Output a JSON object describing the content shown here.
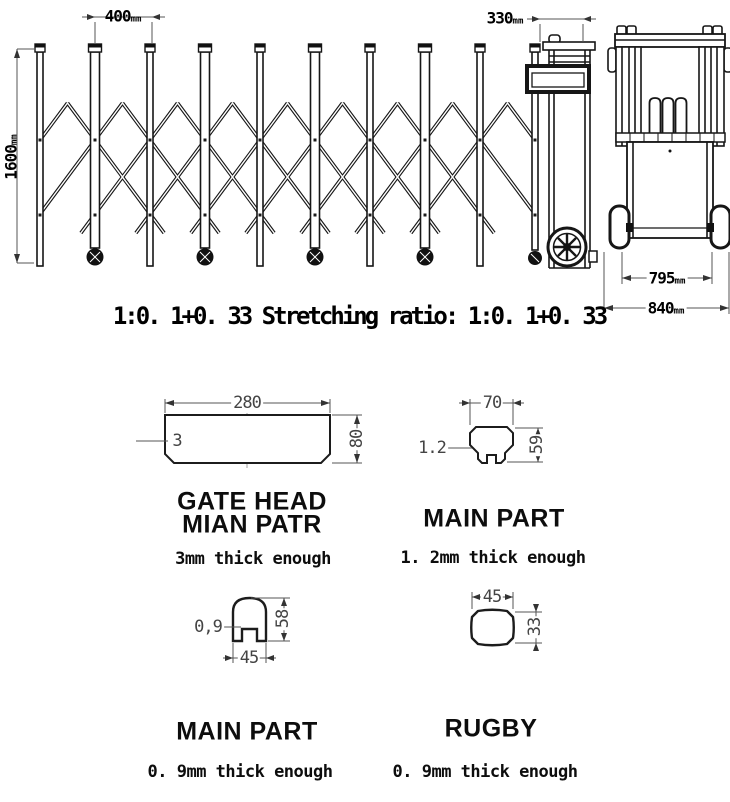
{
  "gate_view": {
    "dims": {
      "bay_width": {
        "value": "400",
        "unit": "mm"
      },
      "head_width": {
        "value": "330",
        "unit": "mm"
      },
      "height": {
        "value": "1600",
        "unit": "mm"
      }
    }
  },
  "side_view": {
    "dims": {
      "inner_width": {
        "value": "795",
        "unit": "mm"
      },
      "outer_width": {
        "value": "840",
        "unit": "mm"
      }
    }
  },
  "ratio_caption": "1:0. 1+0. 33 Stretching ratio: 1:0. 1+0. 33",
  "sections": {
    "gate_head": {
      "title_line1": "GATE HEAD",
      "title_line2": "MIAN PATR",
      "thickness": "3mm thick enough",
      "dims": {
        "width": "280",
        "height": "80",
        "wall": "3"
      }
    },
    "main_part_large": {
      "title": "MAIN PART",
      "thickness": "1. 2mm thick enough",
      "dims": {
        "width": "70",
        "height": "59",
        "wall": "1.2"
      }
    },
    "main_part_small": {
      "title": "MAIN PART",
      "thickness": "0. 9mm thick enough",
      "dims": {
        "width": "45",
        "height": "58",
        "wall": "0,9"
      }
    },
    "rugby": {
      "title": "RUGBY",
      "thickness": "0. 9mm thick enough",
      "dims": {
        "width": "45",
        "height": "33"
      }
    }
  },
  "colors": {
    "line": "#161616",
    "dim_line": "#555555",
    "arrow": "#333333"
  }
}
